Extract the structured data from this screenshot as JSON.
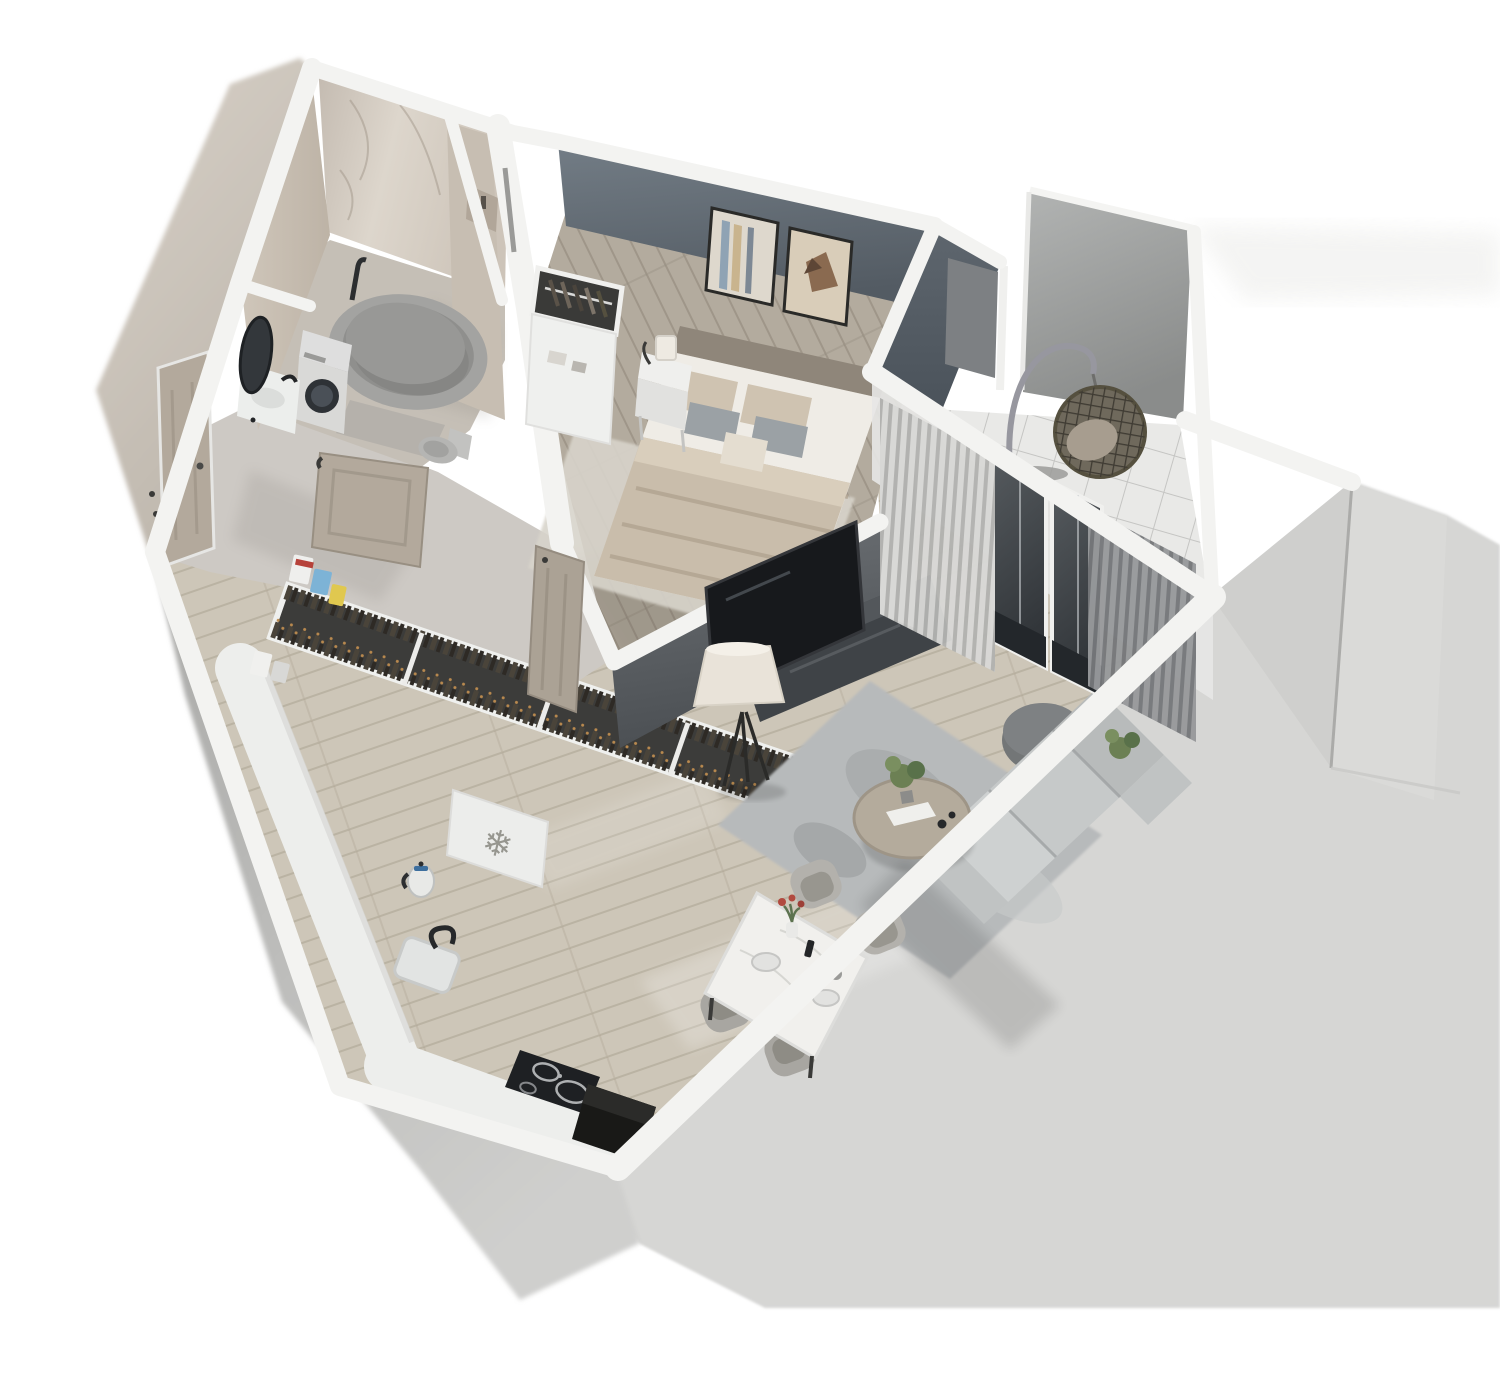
{
  "meta": {
    "title": "3D isometric floor plan render of a one-bedroom apartment",
    "view": "cutaway dollhouse top-down perspective",
    "visible_text": "none"
  },
  "icons": {
    "snowflake": {
      "name": "snowflake-icon",
      "glyph": "❄"
    }
  },
  "palette": {
    "bg": "#ffffff",
    "ext": "#d6d6d4",
    "ext-dark": "#cfcfcd",
    "ext-left": "#b3b3b1",
    "ext-beige": "#cfc8bf",
    "band": "#f3f3f1",
    "accent": "#68727b",
    "accent-dark": "#545c64",
    "marble": "#d6cec4",
    "wood": "#cdc6b8",
    "wood-bed": "#b3ab9e",
    "hall": "#cdc9c4",
    "tile": "#e9e9e7",
    "rug": "#b7babb",
    "rug-bed": "#d8d4cb",
    "sofa": "#c6c9c9",
    "pouf": "#737677",
    "console": "#3f4347",
    "tv": "#17191c",
    "shade": "#e9e3d9",
    "duvet": "#c9bdab",
    "mattress": "#efece6",
    "headboard": "#8f867a",
    "table-marble": "#f1f0ed",
    "chair": "#b3b1ac",
    "curtain": "#c9c9c7",
    "curtain-dark": "#868889",
    "glass": "#43484c",
    "tub": "#a3a3a1",
    "appliance": "#d9d9d7",
    "closet": "#3c3c3a",
    "door": "#b3a99c",
    "plant": "#6c8054",
    "flower": "#b14a3f",
    "panel": "#9fa1a0"
  },
  "rooms": [
    {
      "id": "bathroom",
      "name": "Bathroom",
      "features": [
        "marble walls",
        "oval bathtub",
        "washing machine",
        "sink vanity",
        "oval mirror",
        "toilet",
        "bath mat"
      ]
    },
    {
      "id": "hallway",
      "name": "Entry hallway",
      "features": [
        "entrance door",
        "open bathroom door",
        "built-in closet full of hanging clothes",
        "storage boxes"
      ]
    },
    {
      "id": "kitchen",
      "name": "Kitchen",
      "features": [
        "L-shaped counter",
        "fridge cabinet with snowflake symbol",
        "electric kettle",
        "sink with faucet",
        "induction cooktop",
        "dark appliance niche"
      ]
    },
    {
      "id": "bedroom",
      "name": "Bedroom",
      "features": [
        "slate accent wall",
        "two framed artworks",
        "double bed with beige duvet and pillows",
        "headboard",
        "nightstand with lamp",
        "open-top wardrobe with hangers",
        "light rug",
        "open door"
      ]
    },
    {
      "id": "living",
      "name": "Living room",
      "features": [
        "TV on partition wall",
        "dark media console",
        "tripod floor lamp",
        "round coffee table with plant",
        "gray mottled rug",
        "round pouf",
        "corner sofa",
        "sheer curtains",
        "sliding glass door"
      ]
    },
    {
      "id": "dining",
      "name": "Dining area",
      "features": [
        "white marble dining table",
        "four upholstered chairs",
        "vase with red flowers",
        "tableware"
      ]
    },
    {
      "id": "balcony",
      "name": "Balcony",
      "features": [
        "white tiled floor",
        "gray wall panels",
        "rattan hanging egg chair on stand",
        "glazed wall"
      ]
    }
  ]
}
